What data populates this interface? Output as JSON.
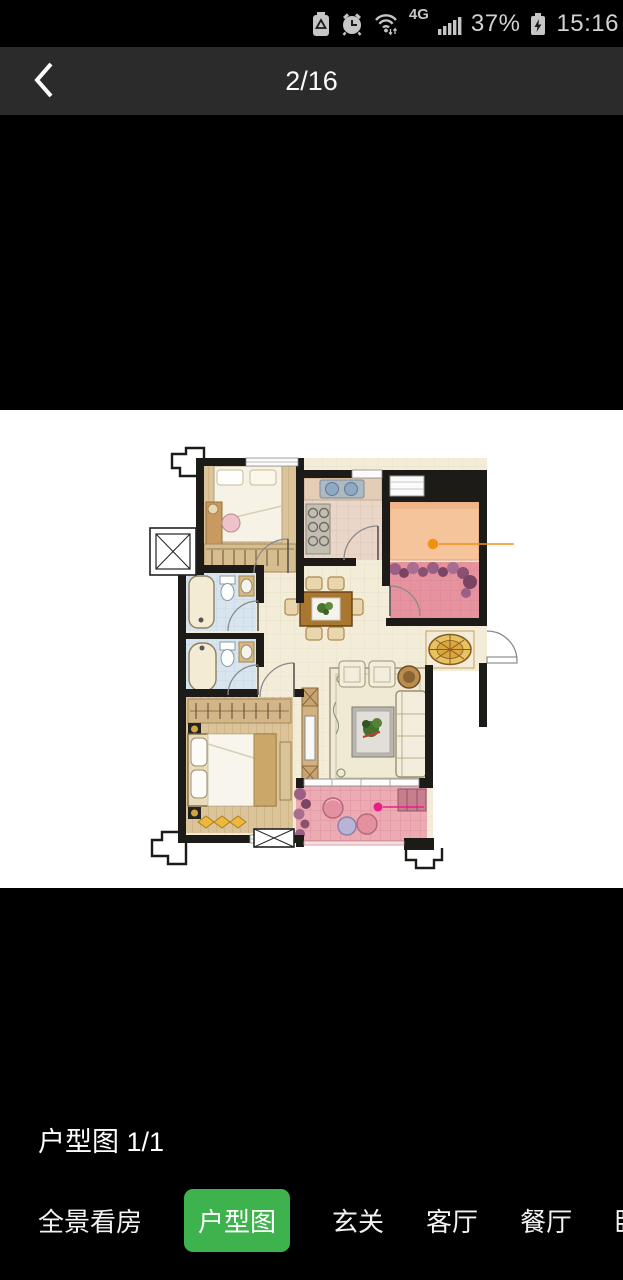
{
  "status_bar": {
    "battery_percent": "37%",
    "time": "15:16",
    "network": "4G",
    "icons": [
      "battery-saver-icon",
      "alarm-icon",
      "wifi-icon",
      "signal-icon",
      "battery-charging-icon"
    ]
  },
  "header": {
    "page_indicator": "2/16"
  },
  "viewer": {
    "caption": "户型图 1/1",
    "content": "apartment floor plan drawing",
    "hotspots": {
      "orange": "#f09012",
      "magenta": "#ea1d8d"
    }
  },
  "tabs": [
    {
      "label": "全景看房",
      "active": false
    },
    {
      "label": "户型图",
      "active": true
    },
    {
      "label": "玄关",
      "active": false
    },
    {
      "label": "客厅",
      "active": false
    },
    {
      "label": "餐厅",
      "active": false
    },
    {
      "label": "卧",
      "active": false
    }
  ],
  "colors": {
    "accent_green": "#3db24d",
    "appbar_bg": "#2b2b2b"
  }
}
